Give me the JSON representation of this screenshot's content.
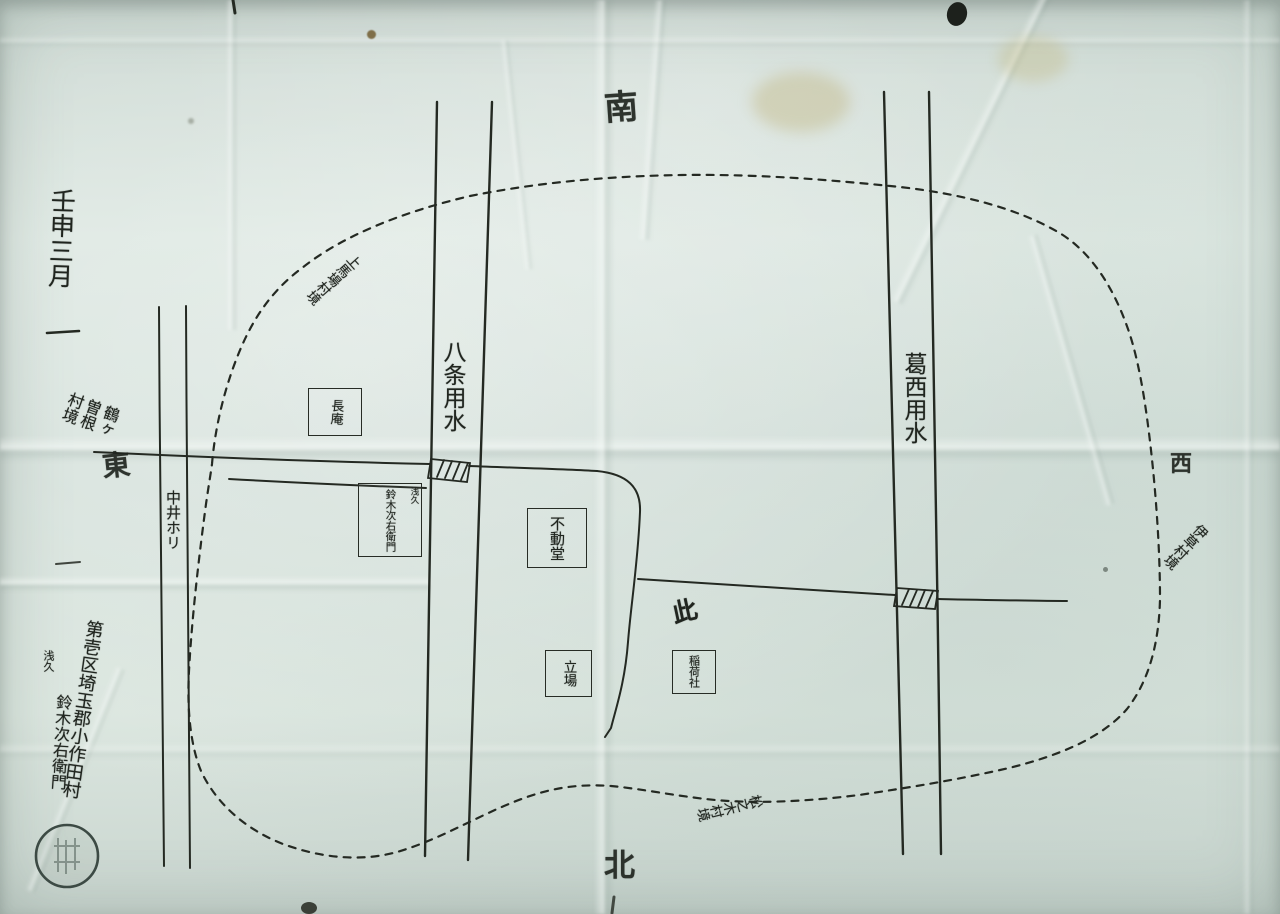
{
  "map": {
    "compass": {
      "top": "南",
      "bottom": "北",
      "left": "東",
      "right": "西"
    },
    "date": "壬申三月",
    "waterways": [
      {
        "id": "hachijo-canal",
        "label": "八条用水"
      },
      {
        "id": "kasai-canal",
        "label": "葛西用水"
      },
      {
        "id": "nakai-ditch",
        "label": "中井ホリ"
      }
    ],
    "boundary_labels": [
      {
        "position": "upper-left",
        "text": "上馬場村境"
      },
      {
        "position": "left",
        "text": "鶴ヶ曽根村境"
      },
      {
        "position": "right",
        "text": "伊草村境"
      },
      {
        "position": "bottom",
        "text": "松之木村境"
      }
    ],
    "landmarks": [
      {
        "id": "chouan",
        "label": "長庵"
      },
      {
        "id": "suzuki-plot",
        "annotation": "浅久",
        "label": "鈴木次右衛門"
      },
      {
        "id": "fudodo-hall",
        "label": "不動堂"
      },
      {
        "id": "tateba",
        "label": "立場"
      },
      {
        "id": "inari-shrine",
        "label": "稲荷社"
      },
      {
        "id": "field-mark",
        "label": "此"
      }
    ],
    "signature": {
      "district": "第壱区埼玉郡小作田村",
      "annotation": "浅久",
      "name": "鈴木次右衛門"
    },
    "ink_color": "#20251f",
    "paper_color": "#d5e1db"
  }
}
